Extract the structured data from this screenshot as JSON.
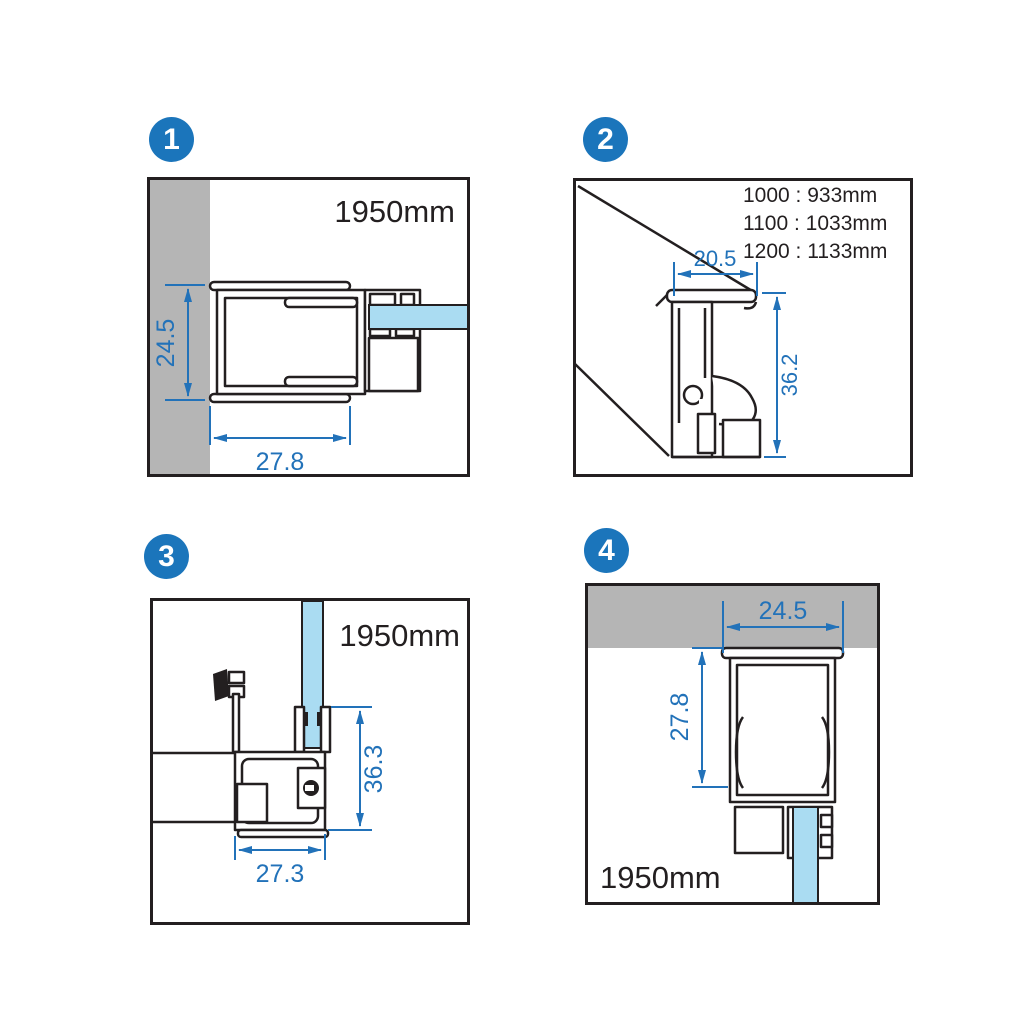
{
  "colors": {
    "badge": "#1b75bb",
    "dim": "#2272b9",
    "glass": "#aadcf2",
    "wall": "#b5b5b5",
    "line": "#231f20",
    "bg": "#ffffff"
  },
  "panels": [
    {
      "number": "1",
      "height_label": "1950mm",
      "dims": {
        "vertical": "24.5",
        "horizontal": "27.8"
      }
    },
    {
      "number": "2",
      "ratios": [
        "1000 : 933mm",
        "1100 : 1033mm",
        "1200 : 1133mm"
      ],
      "dims": {
        "top": "20.5",
        "side": "36.2"
      }
    },
    {
      "number": "3",
      "height_label": "1950mm",
      "dims": {
        "side": "36.3",
        "bottom": "27.3"
      }
    },
    {
      "number": "4",
      "height_label": "1950mm",
      "dims": {
        "top": "24.5",
        "side": "27.8"
      }
    }
  ]
}
